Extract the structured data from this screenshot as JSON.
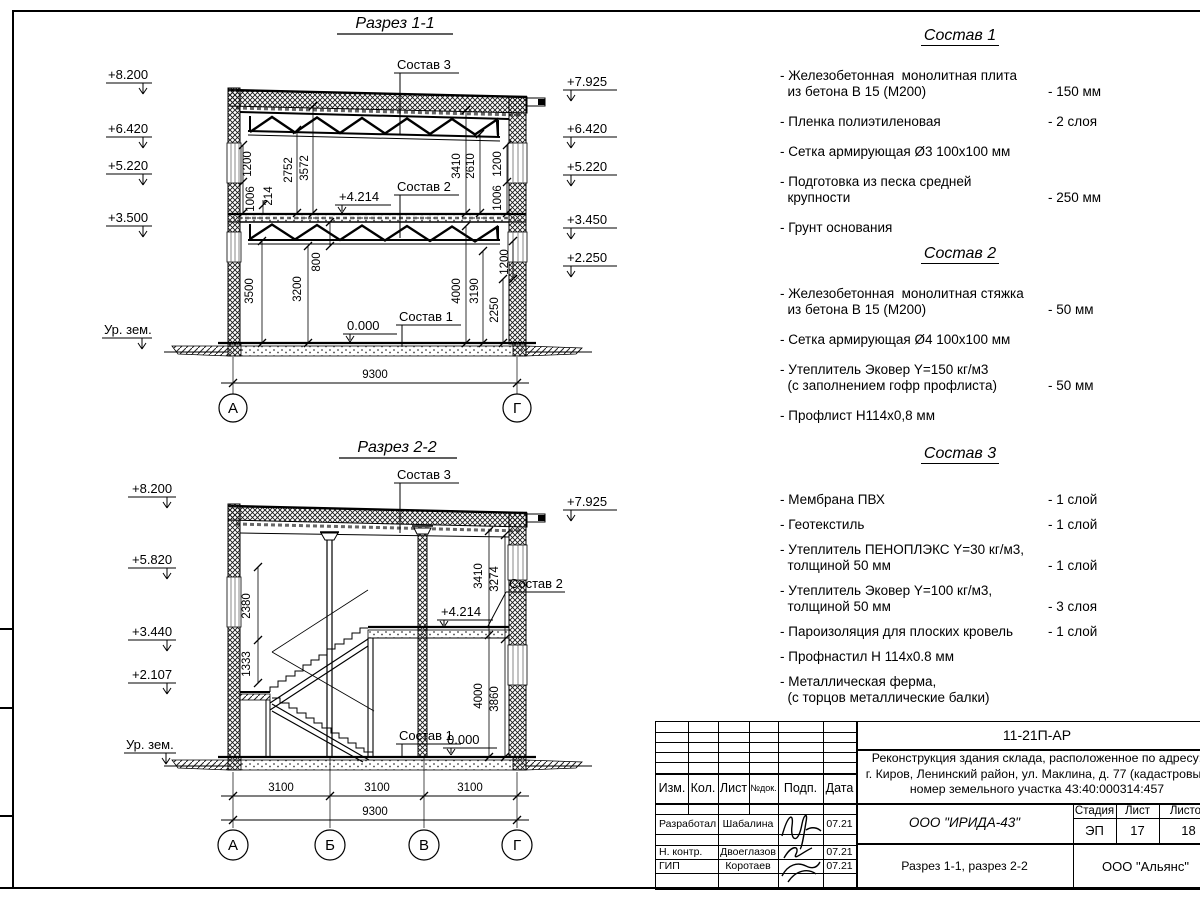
{
  "s1": {
    "title": "Разрез 1-1",
    "elev": {
      "e0": "+8.200",
      "e1": "+6.420",
      "e2": "+5.220",
      "e3": "+3.500",
      "ground": "Ур. зем.",
      "r0": "+7.925",
      "r1": "+6.420",
      "r2": "+5.220",
      "r3": "+3.450",
      "r4": "+2.250",
      "mid": "+4.214",
      "zero": "0.000"
    },
    "lead": {
      "c3": "Состав 3",
      "c2": "Состав 2",
      "c1": "Состав 1"
    },
    "dims": {
      "d1200L": "1200",
      "d1006L": "1006",
      "d214": "214",
      "d2752": "2752",
      "d3572": "3572",
      "d3500": "3500",
      "d3200": "3200",
      "d800": "800",
      "d3410": "3410",
      "d2610": "2610",
      "d1200R": "1200",
      "d1006R": "1006",
      "d4000": "4000",
      "d3190": "3190",
      "d2250": "2250",
      "d1200R2": "1200",
      "total": "9300"
    },
    "axes": {
      "a": "А",
      "g": "Г"
    }
  },
  "s2": {
    "title": "Разрез 2-2",
    "elev": {
      "e0": "+8.200",
      "e1": "+5.820",
      "e2": "+3.440",
      "e3": "+2.107",
      "ground": "Ур. зем.",
      "r0": "+7.925",
      "mid": "+4.214",
      "zero": "0.000"
    },
    "lead": {
      "c3": "Состав 3",
      "c2": "Состав 2",
      "c1": "Состав 1"
    },
    "dims": {
      "d2380": "2380",
      "d1333": "1333",
      "d3410": "3410",
      "d3274": "3274",
      "d4000": "4000",
      "d3860": "3860",
      "span1": "3100",
      "span2": "3100",
      "span3": "3100",
      "total": "9300"
    },
    "axes": {
      "a": "А",
      "b": "Б",
      "v": "В",
      "g": "Г"
    }
  },
  "compositions": [
    {
      "title": "Состав 1",
      "items": [
        {
          "name": "- Железобетонная  монолитная плита\n  из бетона В 15 (М200)",
          "value": "- 150 мм"
        },
        {
          "name": "- Пленка полиэтиленовая",
          "value": "-  2 слоя"
        },
        {
          "name": "- Сетка армирующая Ø3 100х100 мм",
          "value": ""
        },
        {
          "name": "- Подготовка из песка средней\n  крупности",
          "value": "- 250 мм"
        },
        {
          "name": "- Грунт основания",
          "value": ""
        }
      ]
    },
    {
      "title": "Состав 2",
      "items": [
        {
          "name": "- Железобетонная  монолитная стяжка\n  из бетона В 15 (М200)",
          "value": "- 50 мм"
        },
        {
          "name": "- Сетка армирующая Ø4 100х100 мм",
          "value": ""
        },
        {
          "name": "- Утеплитель Эковер Y=150 кг/м3\n  (с заполнением гофр профлиста)",
          "value": "- 50 мм"
        },
        {
          "name": "- Профлист Н114х0,8 мм",
          "value": ""
        }
      ]
    },
    {
      "title": "Состав 3",
      "items": [
        {
          "name": "- Мембрана ПВХ",
          "value": "- 1 слой"
        },
        {
          "name": "- Геотекстиль",
          "value": "- 1 слой"
        },
        {
          "name": "- Утеплитель ПЕНОПЛЭКС Y=30 кг/м3,\n  толщиной 50 мм",
          "value": "- 1 слой"
        },
        {
          "name": "- Утеплитель Эковер Y=100 кг/м3,\n  толщиной 50 мм",
          "value": "- 3 слоя"
        },
        {
          "name": "- Пароизоляция для плоских кровель",
          "value": "- 1 слой"
        },
        {
          "name": "- Профнастил Н 114х0.8 мм",
          "value": ""
        },
        {
          "name": "- Металлическая ферма,\n  (с торцов металлические балки)",
          "value": ""
        }
      ]
    }
  ],
  "sheet": {
    "code": "11-21П-АР",
    "desc1": "Реконструкция здания склада, расположенное по адресу:",
    "desc2": "г. Киров, Ленинский район, ул. Маклина, д. 77 (кадастровый",
    "desc3": "номер земельного участка 43:40:000314:457",
    "org": "ООО \"ИРИДА-43\"",
    "contractor": "ООО \"Альянс\"",
    "sheet_title": "Разрез 1-1, разрез 2-2",
    "stage_label": "Стадия",
    "list_label": "Лист",
    "lists_label": "Листов",
    "stage": "ЭП",
    "sheet_no": "17",
    "sheets_total": "18",
    "hdr": {
      "izm": "Изм.",
      "kol": "Кол.",
      "list": "Лист",
      "ndok": "№док.",
      "podp": "Подп.",
      "data": "Дата"
    },
    "roles": [
      {
        "role": "Разработал",
        "name": "Шабалина",
        "date": "07.21"
      },
      {
        "role": "Н. контр.",
        "name": "Двоеглазов",
        "date": "07.21"
      },
      {
        "role": "ГИП",
        "name": "Коротаев",
        "date": "07.21"
      }
    ]
  }
}
